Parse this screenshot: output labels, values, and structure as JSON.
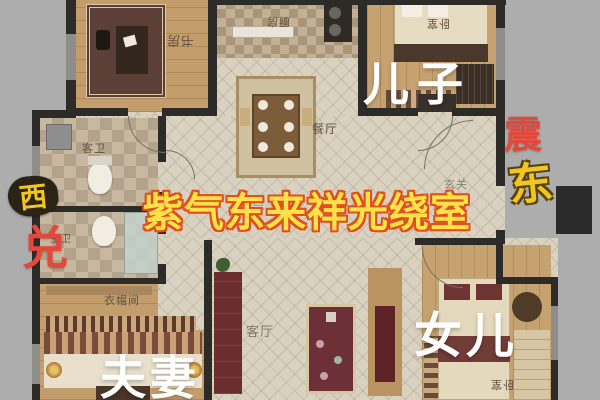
{
  "rooms": {
    "study": "书房",
    "kitchen": "厨房",
    "bedroom_top": "卧室",
    "dining": "餐厅",
    "guest_bath": "客卫",
    "master_bath": "主卫",
    "cloakroom": "衣帽间",
    "living": "客厅",
    "entry": "玄关",
    "bedroom_bottom": "卧室"
  },
  "people_labels": {
    "son": "儿子",
    "couple": "夫妻",
    "daughter": "女儿"
  },
  "compass": {
    "west": "西",
    "dui": "兑",
    "zhen": "震",
    "east": "东"
  },
  "overlay": {
    "blessing": "紫气东来祥光绕室",
    "watermark": "点击关注"
  },
  "colors": {
    "background": "#adadad",
    "blessing_fill": "#ffe24a",
    "blessing_stroke": "#e04f1e",
    "red_char": "#e0493c",
    "gold_char": "#f2c522",
    "wall": "#2d2b28",
    "overlay_white": "#ffffff"
  }
}
